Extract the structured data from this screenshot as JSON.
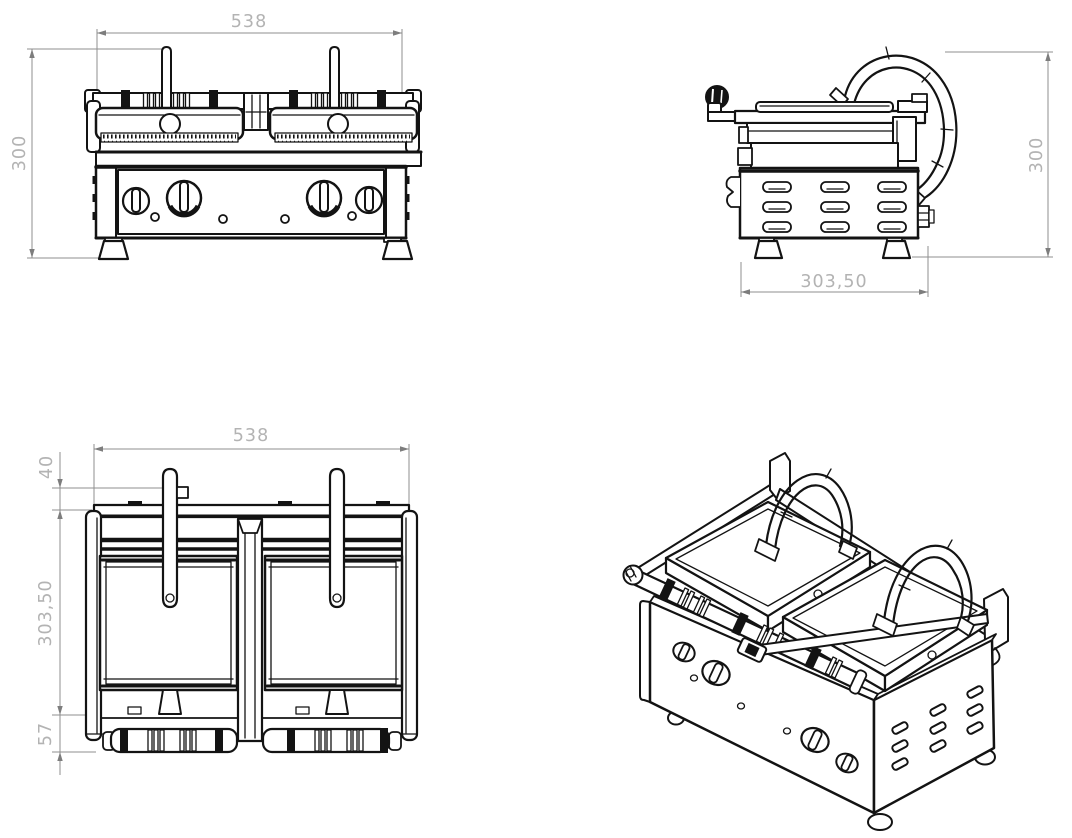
{
  "colors": {
    "background": "#ffffff",
    "object_line": "#131313",
    "dim_line": "#8f8f8f",
    "dim_text": "#b3b3b3"
  },
  "views": {
    "front": {
      "width_dim": "538",
      "height_dim": "300"
    },
    "side": {
      "depth_dim": "303,50",
      "height_dim": "300"
    },
    "top": {
      "width_dim": "538",
      "handle_offset_dim": "40",
      "depth_dim": "303,50",
      "hinge_offset_dim": "57"
    }
  }
}
